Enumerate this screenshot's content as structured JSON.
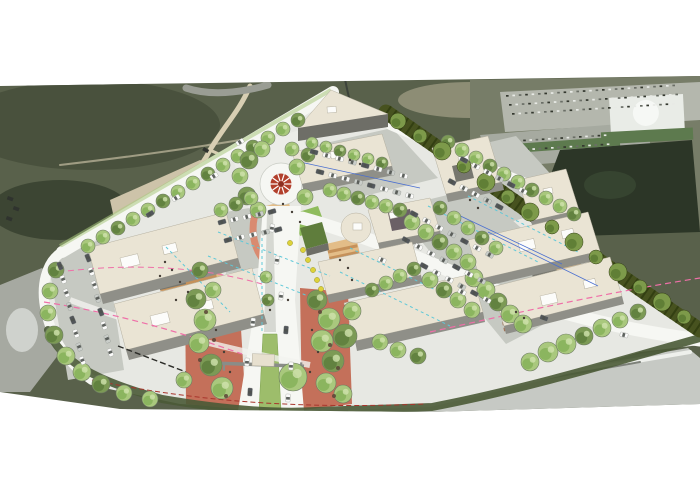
{
  "palette": {
    "bg": "#ffffff",
    "scrub": "#59614b",
    "scrubDark": "#49513d",
    "scrubDarker": "#3c4533",
    "dirt": "#cdc3a9",
    "dirtLight": "#ddd3b8",
    "dirtPath": "#d8cfb3",
    "satRoad": "#9a9d94",
    "satParking": "#b4b7ad",
    "satParking2": "#a6aaa0",
    "satBuildingRoof": "#e9ece7",
    "satGreen": "#5d7a4e",
    "satTrees": "#2c3627",
    "rock": "#a6a9a1",
    "blurRoad": "#c6c9c4",
    "blurStreak": "#7d8179",
    "blurWhite": "#eef0ec",
    "siteGround": "#e7e8e3",
    "roadWhite": "#f6f7f3",
    "parking": "#c6c9c2",
    "building": "#eae4d4",
    "buildingEdge": "#b5b0a0",
    "buildingSide": "#8f8f88",
    "buildingDark": "#6e6e67",
    "buildingCore": "#77776f",
    "roofUnit": "#fcfcfa",
    "darkRoofSection": "#6b6066",
    "terracotta": "#c4705a",
    "terracottaLight": "#d98a70",
    "plazaTan": "#e3bd88",
    "plazaStripe": "#c08a52",
    "deckBrown": "#9b6647",
    "lawn": "#8fbc5d",
    "median": "#9dbd6b",
    "medianEdge": "#7da14f",
    "greenRoof": "#5f7d3c",
    "treeFill": "#a9c87d",
    "treeDark": "#86b159",
    "treeLight": "#cfe2ad",
    "treeLine": "#6d7b62",
    "treeShade": "#7c9a55",
    "treeShadeDark": "#5e7e3d",
    "hedge": "#47521f",
    "hedgeDark": "#333f12",
    "hedgeTree": "#7d9a4a",
    "hedgeTreeDark": "#5a7a32",
    "slope": "#4a5a36",
    "pink": "#ef6fa8",
    "cyan": "#5fc8d8",
    "blue": "#4a6fd0",
    "redDash": "#a8352c",
    "carWhite": "#fbfbfa",
    "carDark": "#52565a",
    "carSilver": "#c9cdc9",
    "carGlass": "#4e524e",
    "roundabout": "#b2402c",
    "roundaboutDark": "#8c2f22",
    "yellow": "#ddd23a",
    "yellowEdge": "#9a9426",
    "person": "#463f37",
    "debris": "#5a4436",
    "gateway": "#8a8d88",
    "canopy": "#e7e0cf"
  },
  "scene": {
    "roundabout": {
      "cx": 281,
      "cy": 184,
      "r_outer": 21,
      "r_inner": 10.5,
      "spokes": 10
    },
    "trees": [
      [
        298,
        120,
        7
      ],
      [
        283,
        129,
        7
      ],
      [
        268,
        138,
        7
      ],
      [
        253,
        147,
        7
      ],
      [
        238,
        156,
        7
      ],
      [
        223,
        165,
        7
      ],
      [
        208,
        174,
        7
      ],
      [
        193,
        183,
        7
      ],
      [
        178,
        192,
        7
      ],
      [
        163,
        201,
        7
      ],
      [
        148,
        210,
        7
      ],
      [
        133,
        219,
        7
      ],
      [
        118,
        228,
        7
      ],
      [
        103,
        237,
        7
      ],
      [
        88,
        246,
        7
      ],
      [
        56,
        270,
        8
      ],
      [
        50,
        291,
        8
      ],
      [
        48,
        313,
        8
      ],
      [
        54,
        335,
        9
      ],
      [
        66,
        356,
        9
      ],
      [
        82,
        372,
        9
      ],
      [
        101,
        384,
        9
      ],
      [
        124,
        393,
        8
      ],
      [
        150,
        399,
        8
      ],
      [
        249,
        160,
        9
      ],
      [
        262,
        149,
        8
      ],
      [
        240,
        176,
        8
      ],
      [
        247,
        196,
        9
      ],
      [
        258,
        210,
        8
      ],
      [
        297,
        167,
        8
      ],
      [
        308,
        155,
        7
      ],
      [
        292,
        149,
        7
      ],
      [
        305,
        197,
        8
      ],
      [
        196,
        299,
        10
      ],
      [
        205,
        320,
        11
      ],
      [
        199,
        343,
        10
      ],
      [
        211,
        365,
        11
      ],
      [
        222,
        388,
        11
      ],
      [
        184,
        380,
        8
      ],
      [
        317,
        300,
        10
      ],
      [
        329,
        319,
        11
      ],
      [
        322,
        341,
        11
      ],
      [
        333,
        361,
        11
      ],
      [
        326,
        383,
        10
      ],
      [
        343,
        394,
        9
      ],
      [
        345,
        336,
        12
      ],
      [
        352,
        311,
        9
      ],
      [
        293,
        377,
        14
      ],
      [
        268,
        300,
        6
      ],
      [
        266,
        277,
        6
      ],
      [
        221,
        210,
        7
      ],
      [
        236,
        204,
        7
      ],
      [
        251,
        198,
        7
      ],
      [
        213,
        290,
        8
      ],
      [
        200,
        270,
        8
      ],
      [
        312,
        143,
        6
      ],
      [
        326,
        147,
        6
      ],
      [
        340,
        151,
        6
      ],
      [
        354,
        155,
        6
      ],
      [
        368,
        159,
        6
      ],
      [
        382,
        163,
        6
      ],
      [
        330,
        190,
        7
      ],
      [
        344,
        194,
        7
      ],
      [
        358,
        198,
        7
      ],
      [
        372,
        202,
        7
      ],
      [
        386,
        206,
        7
      ],
      [
        400,
        210,
        7
      ],
      [
        412,
        222,
        8
      ],
      [
        426,
        232,
        8
      ],
      [
        440,
        242,
        8
      ],
      [
        454,
        252,
        8
      ],
      [
        468,
        262,
        8
      ],
      [
        440,
        208,
        7
      ],
      [
        454,
        218,
        7
      ],
      [
        468,
        228,
        7
      ],
      [
        482,
        238,
        7
      ],
      [
        496,
        248,
        7
      ],
      [
        430,
        280,
        8
      ],
      [
        444,
        290,
        8
      ],
      [
        458,
        300,
        8
      ],
      [
        472,
        310,
        8
      ],
      [
        448,
        142,
        7
      ],
      [
        462,
        150,
        7
      ],
      [
        476,
        158,
        7
      ],
      [
        490,
        166,
        7
      ],
      [
        504,
        174,
        7
      ],
      [
        518,
        182,
        7
      ],
      [
        532,
        190,
        7
      ],
      [
        546,
        198,
        7
      ],
      [
        560,
        206,
        7
      ],
      [
        574,
        214,
        7
      ],
      [
        474,
        278,
        9
      ],
      [
        486,
        290,
        9
      ],
      [
        498,
        302,
        9
      ],
      [
        510,
        314,
        9
      ],
      [
        523,
        324,
        9
      ],
      [
        372,
        290,
        7
      ],
      [
        386,
        283,
        7
      ],
      [
        400,
        276,
        7
      ],
      [
        414,
        269,
        7
      ],
      [
        380,
        342,
        8
      ],
      [
        398,
        350,
        8
      ],
      [
        418,
        356,
        8
      ],
      [
        548,
        352,
        10
      ],
      [
        566,
        344,
        10
      ],
      [
        584,
        336,
        9
      ],
      [
        602,
        328,
        9
      ],
      [
        620,
        320,
        8
      ],
      [
        638,
        312,
        8
      ],
      [
        530,
        362,
        9
      ]
    ],
    "hedge_trees": [
      [
        398,
        121,
        8
      ],
      [
        420,
        136,
        7
      ],
      [
        442,
        151,
        9
      ],
      [
        464,
        166,
        7
      ],
      [
        486,
        182,
        9
      ],
      [
        508,
        197,
        7
      ],
      [
        530,
        212,
        9
      ],
      [
        552,
        227,
        7
      ],
      [
        574,
        242,
        9
      ],
      [
        596,
        257,
        7
      ],
      [
        618,
        272,
        9
      ],
      [
        640,
        287,
        7
      ],
      [
        662,
        302,
        9
      ],
      [
        684,
        317,
        7
      ]
    ],
    "car_rows": [
      {
        "x": 60,
        "y": 266,
        "dx": 3.2,
        "dy": 13.5,
        "n": 8,
        "rot": 68
      },
      {
        "x": 88,
        "y": 258,
        "dx": 3.2,
        "dy": 13.5,
        "n": 8,
        "rot": 68
      },
      {
        "x": 222,
        "y": 222,
        "dx": 12.5,
        "dy": -2.6,
        "n": 5,
        "rot": -16
      },
      {
        "x": 228,
        "y": 240,
        "dx": 12.5,
        "dy": -2.6,
        "n": 5,
        "rot": -16
      },
      {
        "x": 314,
        "y": 152,
        "dx": 12.8,
        "dy": 3.4,
        "n": 8,
        "rot": 15
      },
      {
        "x": 320,
        "y": 172,
        "dx": 12.8,
        "dy": 3.4,
        "n": 8,
        "rot": 15
      },
      {
        "x": 414,
        "y": 214,
        "dx": 12.6,
        "dy": 6.8,
        "n": 7,
        "rot": 28
      },
      {
        "x": 406,
        "y": 240,
        "dx": 12.6,
        "dy": 6.8,
        "n": 7,
        "rot": 28
      },
      {
        "x": 424,
        "y": 266,
        "dx": 12.6,
        "dy": 6.8,
        "n": 6,
        "rot": 28
      },
      {
        "x": 464,
        "y": 160,
        "dx": 11.8,
        "dy": 6.2,
        "n": 6,
        "rot": 28
      },
      {
        "x": 452,
        "y": 182,
        "dx": 11.8,
        "dy": 6.2,
        "n": 5,
        "rot": 28
      }
    ],
    "cars": [
      [
        250,
        392,
        -86
      ],
      [
        247,
        362,
        -85
      ],
      [
        253,
        322,
        -84
      ],
      [
        288,
        398,
        -87
      ],
      [
        291,
        366,
        -86
      ],
      [
        286,
        330,
        -85
      ],
      [
        281,
        296,
        -83
      ],
      [
        277,
        260,
        -82
      ],
      [
        272,
        228,
        -80
      ],
      [
        176,
        198,
        -32
      ],
      [
        150,
        214,
        -32
      ],
      [
        214,
        176,
        -32
      ],
      [
        240,
        142,
        -32
      ],
      [
        382,
        260,
        24
      ],
      [
        462,
        292,
        26
      ],
      [
        544,
        318,
        20
      ],
      [
        624,
        335,
        14
      ]
    ],
    "sat_car_rows": [
      {
        "x": 506,
        "y": 95,
        "dx": 6.4,
        "dy": -0.4,
        "n": 27
      },
      {
        "x": 509,
        "y": 104,
        "dx": 6.4,
        "dy": -0.4,
        "n": 27
      },
      {
        "x": 512,
        "y": 113,
        "dx": 6.4,
        "dy": -0.4,
        "n": 26
      },
      {
        "x": 486,
        "y": 142,
        "dx": 6.2,
        "dy": -0.4,
        "n": 20
      },
      {
        "x": 489,
        "y": 151,
        "dx": 6.2,
        "dy": -0.4,
        "n": 20
      }
    ],
    "sat_cars": [
      [
        8,
        196,
        20
      ],
      [
        14,
        206,
        20
      ],
      [
        7,
        216,
        20
      ],
      [
        204,
        147,
        30
      ]
    ],
    "skylights": [
      [
        120,
        258,
        18,
        11,
        -14
      ],
      [
        162,
        246,
        14,
        9,
        -14
      ],
      [
        150,
        316,
        18,
        11,
        -14
      ],
      [
        198,
        303,
        14,
        9,
        -14
      ],
      [
        330,
        152,
        10,
        7,
        -11
      ],
      [
        327,
        107,
        9,
        6,
        -4
      ],
      [
        458,
        157,
        10,
        7,
        -13
      ],
      [
        543,
        189,
        9,
        6,
        -12
      ],
      [
        518,
        242,
        16,
        10,
        -13
      ],
      [
        561,
        231,
        12,
        8,
        -13
      ],
      [
        540,
        296,
        16,
        10,
        -13
      ],
      [
        583,
        281,
        12,
        8,
        -13
      ],
      [
        389,
        213,
        8,
        6,
        -12
      ],
      [
        353,
        223,
        9,
        7,
        0
      ]
    ],
    "yellow_objects": [
      [
        303,
        250
      ],
      [
        308,
        260
      ],
      [
        313,
        270
      ],
      [
        317,
        280
      ],
      [
        321,
        289
      ],
      [
        290,
        243
      ]
    ],
    "people": [
      [
        165,
        262
      ],
      [
        172,
        270
      ],
      [
        180,
        282
      ],
      [
        188,
        292
      ],
      [
        160,
        276
      ],
      [
        176,
        300
      ],
      [
        216,
        330
      ],
      [
        224,
        352
      ],
      [
        230,
        372
      ],
      [
        312,
        330
      ],
      [
        318,
        352
      ],
      [
        310,
        372
      ],
      [
        288,
        300
      ],
      [
        270,
        310
      ],
      [
        340,
        260
      ],
      [
        348,
        268
      ],
      [
        352,
        280
      ],
      [
        516,
        312
      ],
      [
        524,
        318
      ],
      [
        283,
        204
      ],
      [
        292,
        212
      ],
      [
        300,
        222
      ],
      [
        470,
        200
      ],
      [
        478,
        208
      ],
      [
        350,
        160
      ],
      [
        360,
        164
      ]
    ],
    "debris": [
      [
        206,
        312
      ],
      [
        214,
        340
      ],
      [
        320,
        312
      ],
      [
        330,
        345
      ],
      [
        338,
        368
      ],
      [
        200,
        360
      ],
      [
        226,
        396
      ],
      [
        334,
        396
      ]
    ],
    "stripes": [
      {
        "x": 150,
        "y": 249,
        "len": 58,
        "ang": -14,
        "n": 11,
        "gap": 6,
        "w": 3.2,
        "cls": "stripeTan"
      },
      {
        "x": 328,
        "y": 252,
        "len": 30,
        "ang": -12,
        "n": 7,
        "gap": 6.5,
        "w": 3,
        "cls": "stripeTan"
      },
      {
        "x": 500,
        "y": 312,
        "len": 38,
        "ang": -12,
        "n": 4,
        "gap": 6,
        "w": 3.5,
        "cls": "stripeBrown"
      },
      {
        "x": 548,
        "y": 257,
        "len": 30,
        "ang": -13,
        "n": 4,
        "gap": 6,
        "w": 3,
        "cls": "stripeTan"
      }
    ],
    "lines": [
      {
        "cls": "line-pink",
        "d": "M44,302 C120,314 180,332 242,354",
        "dash": "6,4",
        "w": 1.2
      },
      {
        "cls": "line-pink",
        "d": "M430,332 C520,312 610,292 700,278",
        "dash": "6,4",
        "w": 1.2
      },
      {
        "cls": "line-pink",
        "d": "M58,272 C140,262 205,268 262,284",
        "dash": "6,4",
        "w": 1
      },
      {
        "cls": "line-cyan",
        "d": "M218,232 L330,276",
        "dash": "3,3",
        "w": 1
      },
      {
        "cls": "line-cyan",
        "d": "M208,256 L318,300",
        "dash": "3,3",
        "w": 1
      },
      {
        "cls": "line-cyan",
        "d": "M350,248 L460,302",
        "dash": "3,3",
        "w": 1
      },
      {
        "cls": "line-cyan",
        "d": "M340,272 L450,326",
        "dash": "3,3",
        "w": 1
      },
      {
        "cls": "line-cyan",
        "d": "M428,206 L538,262",
        "dash": "3,3",
        "w": 1
      },
      {
        "cls": "line-cyan",
        "d": "M468,196 L578,252",
        "dash": "3,3",
        "w": 1
      },
      {
        "cls": "line-cyan",
        "d": "M262,238 L262,332",
        "dash": "3,3",
        "w": 1
      },
      {
        "cls": "line-cyan",
        "d": "M166,247 L230,312",
        "dash": "3,3",
        "w": 1
      },
      {
        "cls": "line-blue",
        "d": "M300,162 L420,188",
        "dash": "",
        "w": 0.8
      },
      {
        "cls": "line-blue",
        "d": "M452,212 L562,264",
        "dash": "",
        "w": 0.8
      },
      {
        "cls": "line-blue",
        "d": "M488,232 L598,286",
        "dash": "",
        "w": 0.8
      },
      {
        "cls": "line-red",
        "d": "M92,380 C200,402 300,409 424,404",
        "dash": "5,3",
        "w": 1
      },
      {
        "cls": "line-black",
        "d": "M118,346 L186,372",
        "dash": "6,3",
        "w": 1.4
      }
    ]
  }
}
